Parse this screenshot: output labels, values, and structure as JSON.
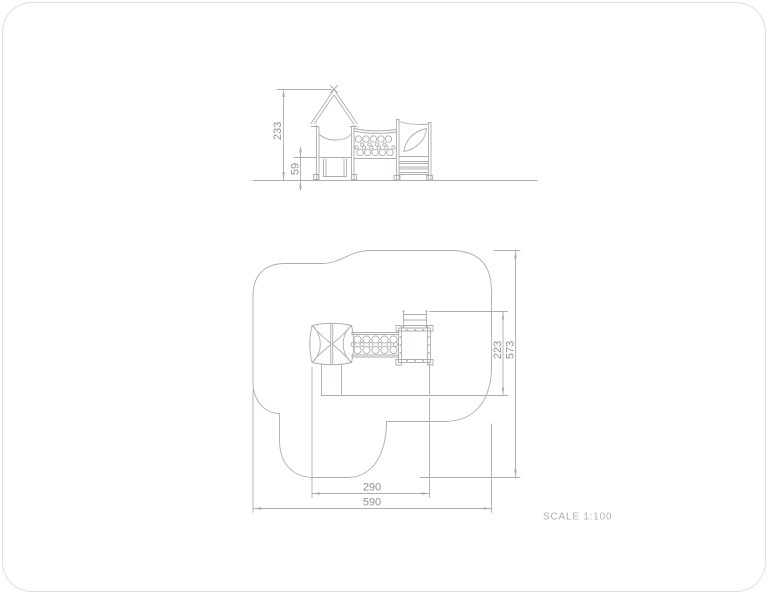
{
  "drawing": {
    "type_label": "playground equipment technical drawing",
    "dimensions": {
      "elevation": {
        "total_height": "233",
        "deck_height": "59"
      },
      "plan": {
        "equipment_depth": "223",
        "safety_zone_depth": "573",
        "equipment_width": "290",
        "safety_zone_width": "590"
      }
    },
    "footer": {
      "scale_label": "SCALE 1:100"
    },
    "colors": {
      "line": "#a9aeb2",
      "dim_text": "#8e9397",
      "scale_text": "#aeb2b6",
      "card_border": "#dcdee0",
      "background": "#ffffff"
    }
  }
}
